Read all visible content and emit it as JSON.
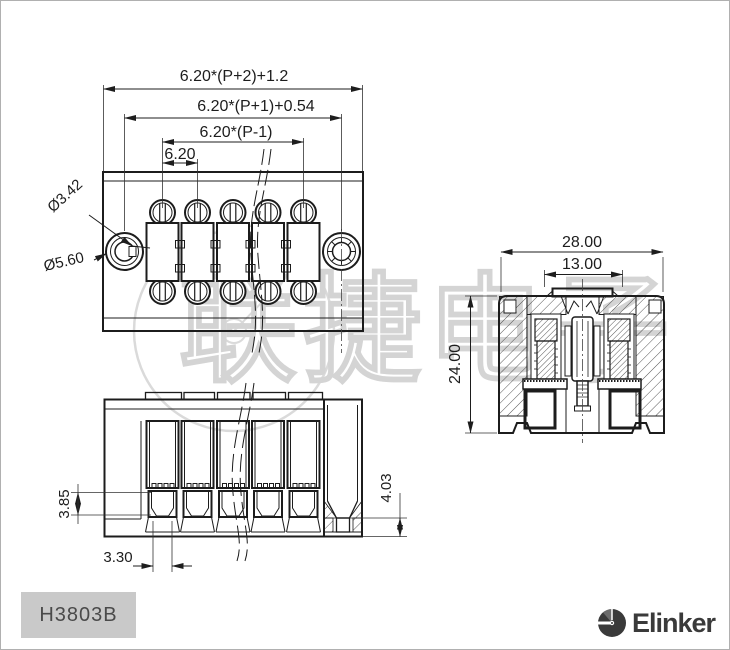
{
  "page": {
    "background": "#ffffff",
    "border_color": "#b0b0b0"
  },
  "title_block": {
    "part_number": "H3803B",
    "box_color": "#c9c9c9"
  },
  "brand": {
    "name": "Elinker",
    "color": "#3a3a3a"
  },
  "watermark": {
    "text": "联捷电子",
    "color": "#d2d2d2"
  },
  "views": {
    "top": {
      "label": "top-view",
      "dim_overall": "6.20*(P+2)+1.2",
      "dim_mounting": "6.20*(P+1)+0.54",
      "dim_poles": "6.20*(P-1)",
      "dim_pitch": "6.20",
      "dim_hole_diameter": "Ø3.42",
      "dim_ear_diameter": "Ø5.60"
    },
    "front": {
      "label": "front-view",
      "dim_opening_height": "3.85",
      "dim_opening_width": "3.30",
      "dim_foot_height": "4.03"
    },
    "section": {
      "label": "side-section-view",
      "dim_width": "28.00",
      "dim_tab_width": "13.00",
      "dim_height": "24.00"
    }
  }
}
